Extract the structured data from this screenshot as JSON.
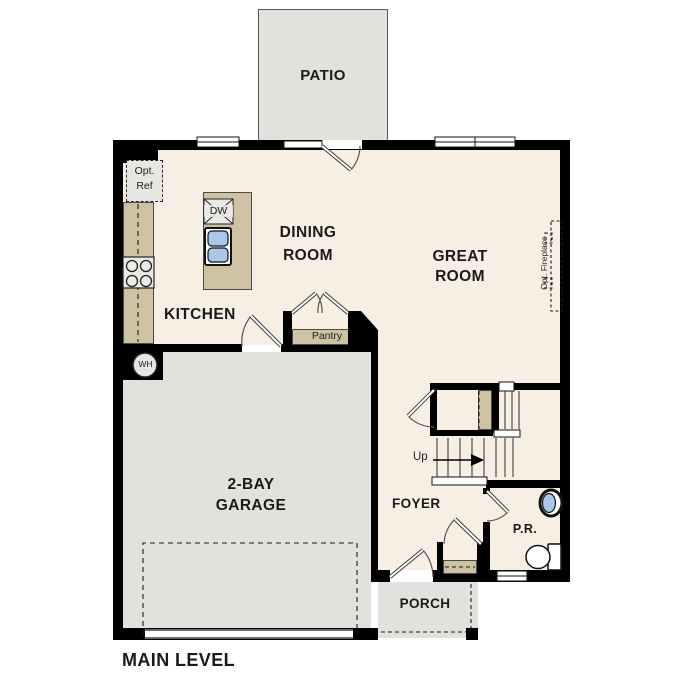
{
  "plan_title": "MAIN LEVEL",
  "rooms": {
    "patio": {
      "label": "PATIO"
    },
    "dining": {
      "line1": "DINING",
      "line2": "ROOM"
    },
    "great": {
      "line1": "GREAT",
      "line2": "ROOM"
    },
    "kitchen": {
      "label": "KITCHEN"
    },
    "garage": {
      "line1": "2-BAY",
      "line2": "GARAGE"
    },
    "foyer": {
      "label": "FOYER"
    },
    "powder_room": {
      "label": "P.R."
    },
    "porch": {
      "label": "PORCH"
    }
  },
  "annotations": {
    "opt_ref": {
      "line1": "Opt.",
      "line2": "Ref"
    },
    "dishwasher": "DW",
    "water_heater": "WH",
    "pantry": "Pantry",
    "stairs_up": "Up",
    "opt_fireplace": "Opt. Fireplace"
  },
  "colors": {
    "wall": "#000000",
    "interior_floor": "#f7efe3",
    "exterior_concrete": "#e2e1de",
    "casework_tan": "#cfc2a3",
    "plumbing_blue": "#a9c8e9"
  }
}
